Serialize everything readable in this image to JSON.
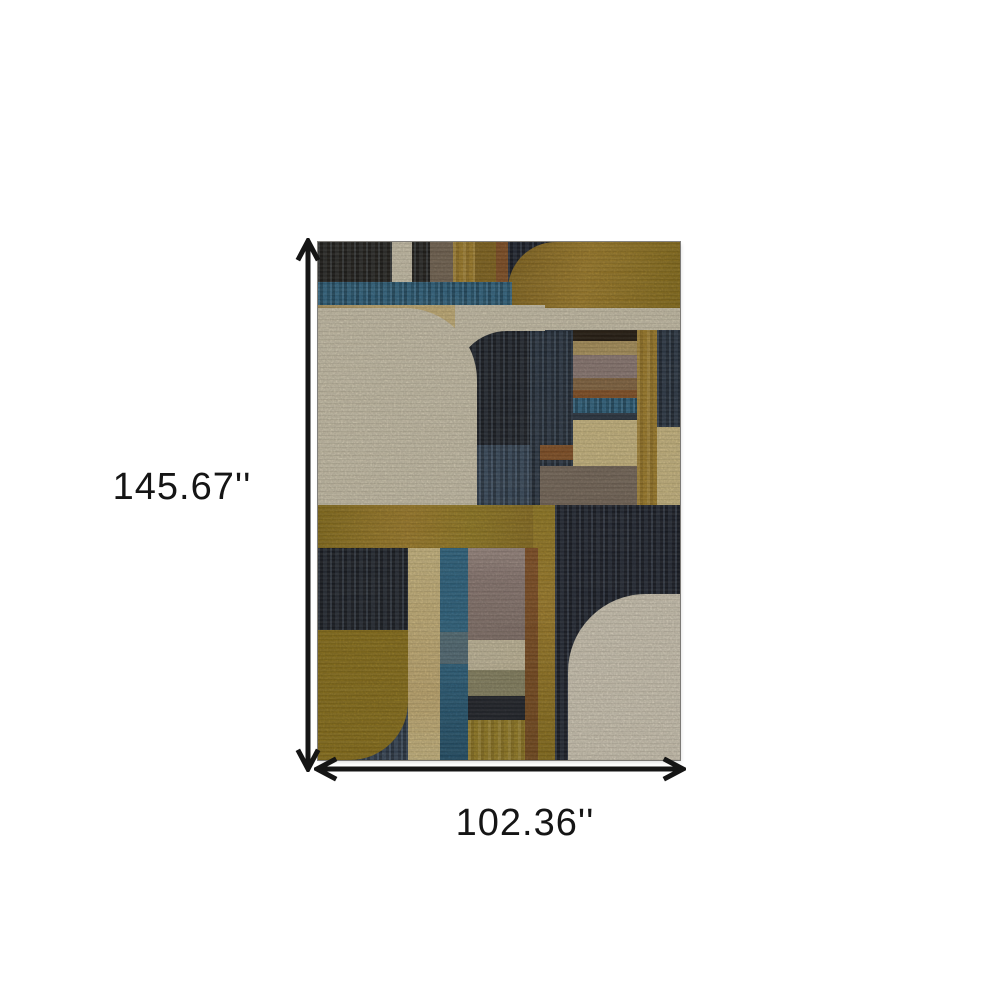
{
  "figure": {
    "type": "product-dimension-diagram",
    "product": "Multicolor geometric art-deco area rug",
    "height_label": "145.67''",
    "width_label": "102.36''",
    "height_arrow_icon": "double-headed-arrow-vertical",
    "width_arrow_icon": "double-headed-arrow-horizontal"
  },
  "palette": {
    "bg": "#ffffff",
    "arrow": "#151515",
    "charcoal": "#2a2722",
    "ink": "#24272e",
    "navy": "#2e3845",
    "navy-deep": "#232630",
    "steel": "#3c4c5e",
    "slate": "#3a4758",
    "teal": "#336a88",
    "teal-deep": "#27546e",
    "teal-grey": "#5f737a",
    "gold": "#a8842f",
    "gold-deep": "#8a6b24",
    "bronze": "#8f7420",
    "olive": "#91761f",
    "olive-2": "#9c8228",
    "pale-gold": "#cdb377",
    "pale-gold-2": "#d7c389",
    "cream": "#d6cdb4",
    "cream-2": "#dcd3bf",
    "sand": "#cfc4a4",
    "tan": "#b49a62",
    "taupe": "#7d6e60",
    "taupe-grey": "#7a6a58",
    "mauve": "#94807a",
    "mauve-light": "#a5928a",
    "mauve-deep": "#8a7870",
    "rust": "#8a552a",
    "brown": "#7a4e22",
    "brown-gold": "#8a6a46",
    "khaki": "#8f8a68",
    "dark-bar": "#2b2218"
  }
}
